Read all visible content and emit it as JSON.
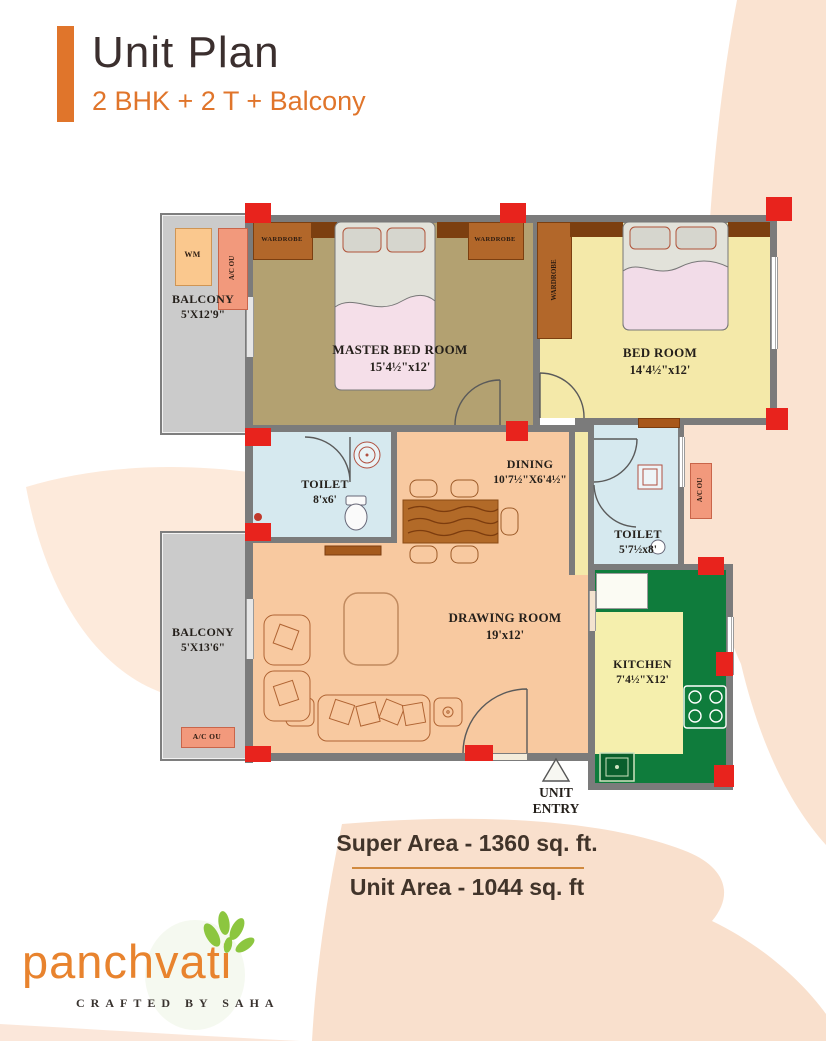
{
  "header": {
    "title": "Unit Plan",
    "subtitle": "2 BHK + 2 T + Balcony"
  },
  "plan": {
    "rooms": {
      "balcony_tl": {
        "name": "BALCONY",
        "dims": "5'X12'9\""
      },
      "master_bedroom": {
        "name": "MASTER BED ROOM",
        "dims": "15'4½\"x12'"
      },
      "bedroom": {
        "name": "BED ROOM",
        "dims": "14'4½\"x12'"
      },
      "toilet_1": {
        "name": "TOILET",
        "dims": "8'x6'"
      },
      "dining": {
        "name": "DINING",
        "dims": "10'7½\"X6'4½\""
      },
      "toilet_2": {
        "name": "TOILET",
        "dims": "5'7½x8'"
      },
      "balcony_bl": {
        "name": "BALCONY",
        "dims": "5'X13'6\""
      },
      "drawing_room": {
        "name": "DRAWING ROOM",
        "dims": "19'x12'"
      },
      "kitchen": {
        "name": "KITCHEN",
        "dims": "7'4½\"X12'"
      }
    },
    "fixtures": {
      "wardrobe": "WARDROBE",
      "wm": "WM",
      "ac_ou": "A/C OU"
    },
    "entry": {
      "line1": "UNIT",
      "line2": "ENTRY"
    }
  },
  "areas": {
    "super": "Super Area - 1360 sq. ft.",
    "unit": "Unit Area - 1044 sq. ft"
  },
  "brand": {
    "logo": "panchvati",
    "tagline": "CRAFTED BY SAHA"
  },
  "colors": {
    "accent_orange": "#e0752b",
    "column_red": "#e8231d",
    "kitchen_green": "#0f7c3c",
    "master_khaki": "#b3a171",
    "bedroom_yellow": "#f4e9a9",
    "toilet_blue": "#d6e9ef",
    "living_peach": "#f8c9a0",
    "balcony_grey": "#cbcbcb",
    "wardrobe_brown": "#b2672a",
    "leaf_background": "#fae3d1"
  }
}
